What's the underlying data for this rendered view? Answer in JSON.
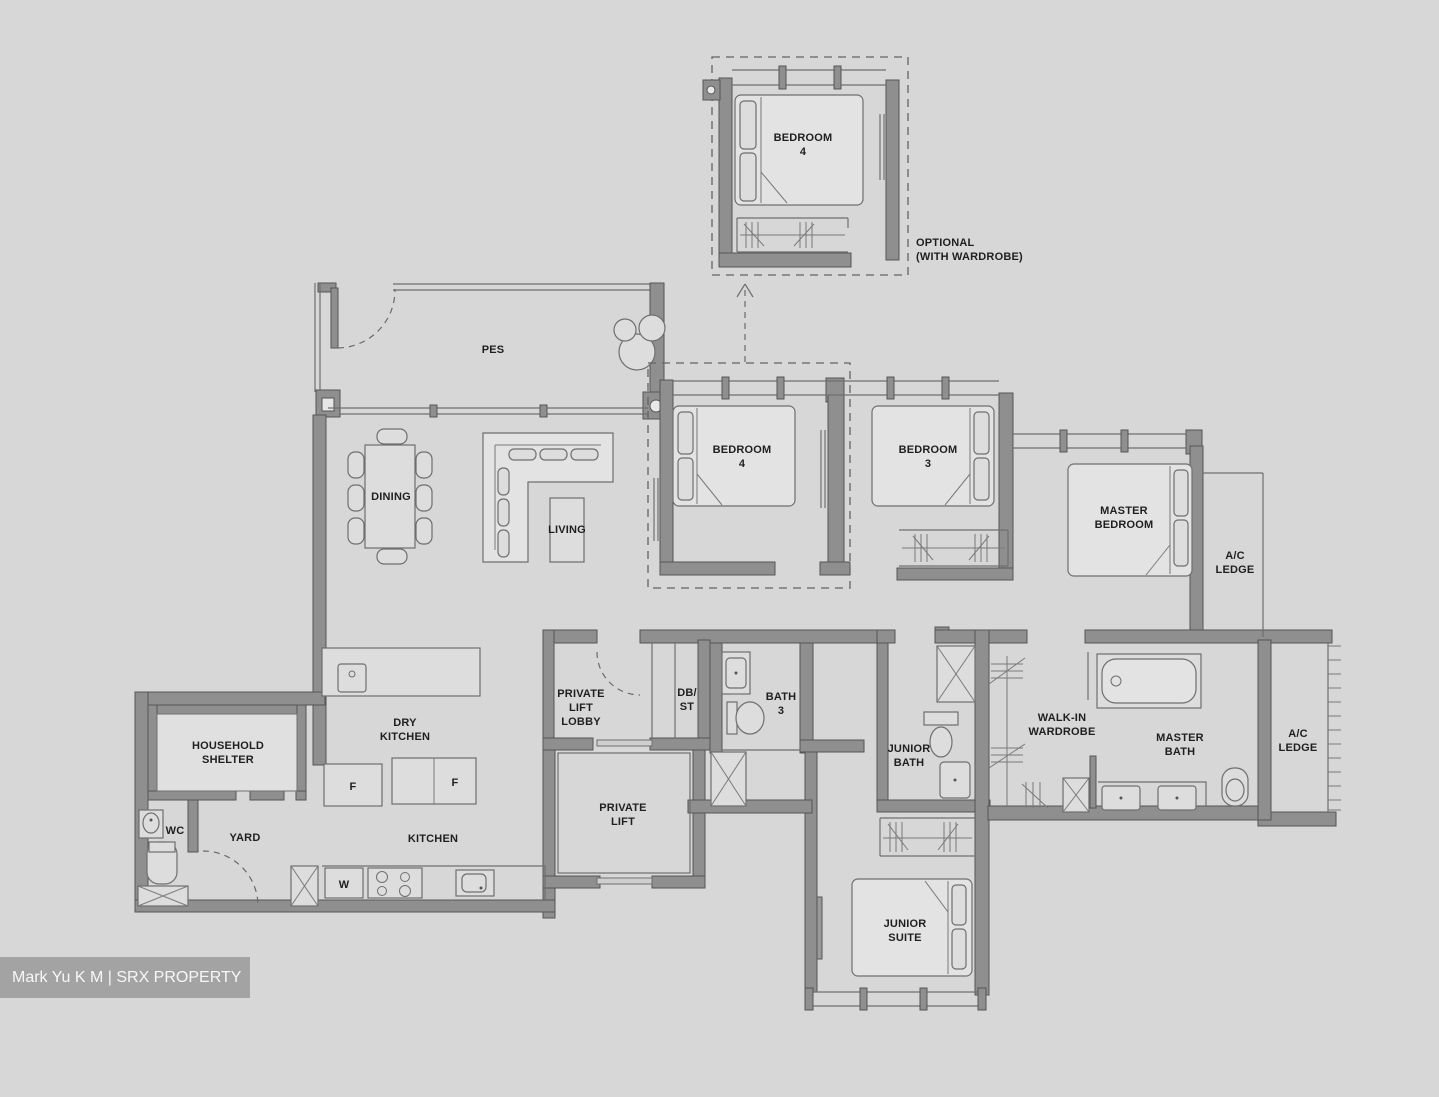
{
  "watermark": "Mark Yu K M | SRX PROPERTY",
  "optional_note": {
    "line1": "OPTIONAL",
    "line2": "(WITH WARDROBE)"
  },
  "labels": {
    "opt_bed_1": "BEDROOM",
    "opt_bed_2": "4",
    "pes": "PES",
    "dining": "DINING",
    "living": "LIVING",
    "bed4_1": "BEDROOM",
    "bed4_2": "4",
    "bed3_1": "BEDROOM",
    "bed3_2": "3",
    "master_1": "MASTER",
    "master_2": "BEDROOM",
    "acl_top_1": "A/C",
    "acl_top_2": "LEDGE",
    "hs_1": "HOUSEHOLD",
    "hs_2": "SHELTER",
    "wc": "WC",
    "yard": "YARD",
    "dryk_1": "DRY",
    "dryk_2": "KITCHEN",
    "kitchen": "KITCHEN",
    "pll_1": "PRIVATE",
    "pll_2": "LIFT",
    "pll_3": "LOBBY",
    "dbst_1": "DB/",
    "dbst_2": "ST",
    "bath3_1": "BATH",
    "bath3_2": "3",
    "plift_1": "PRIVATE",
    "plift_2": "LIFT",
    "jbath_1": "JUNIOR",
    "jbath_2": "BATH",
    "wiw_1": "WALK-IN",
    "wiw_2": "WARDROBE",
    "mbath_1": "MASTER",
    "mbath_2": "BATH",
    "acl_r_1": "A/C",
    "acl_r_2": "LEDGE",
    "jsuite_1": "JUNIOR",
    "jsuite_2": "SUITE"
  },
  "appliances": {
    "fridge1": "F",
    "fridge2": "F",
    "washer": "W"
  },
  "colors": {
    "background": "#d7d7d7",
    "wall": "#8f8f8f",
    "line": "#6f6f6f",
    "text": "#1f1f1f",
    "watermark_bg": "#a3a3a3",
    "watermark_text": "#f7f7f7"
  }
}
